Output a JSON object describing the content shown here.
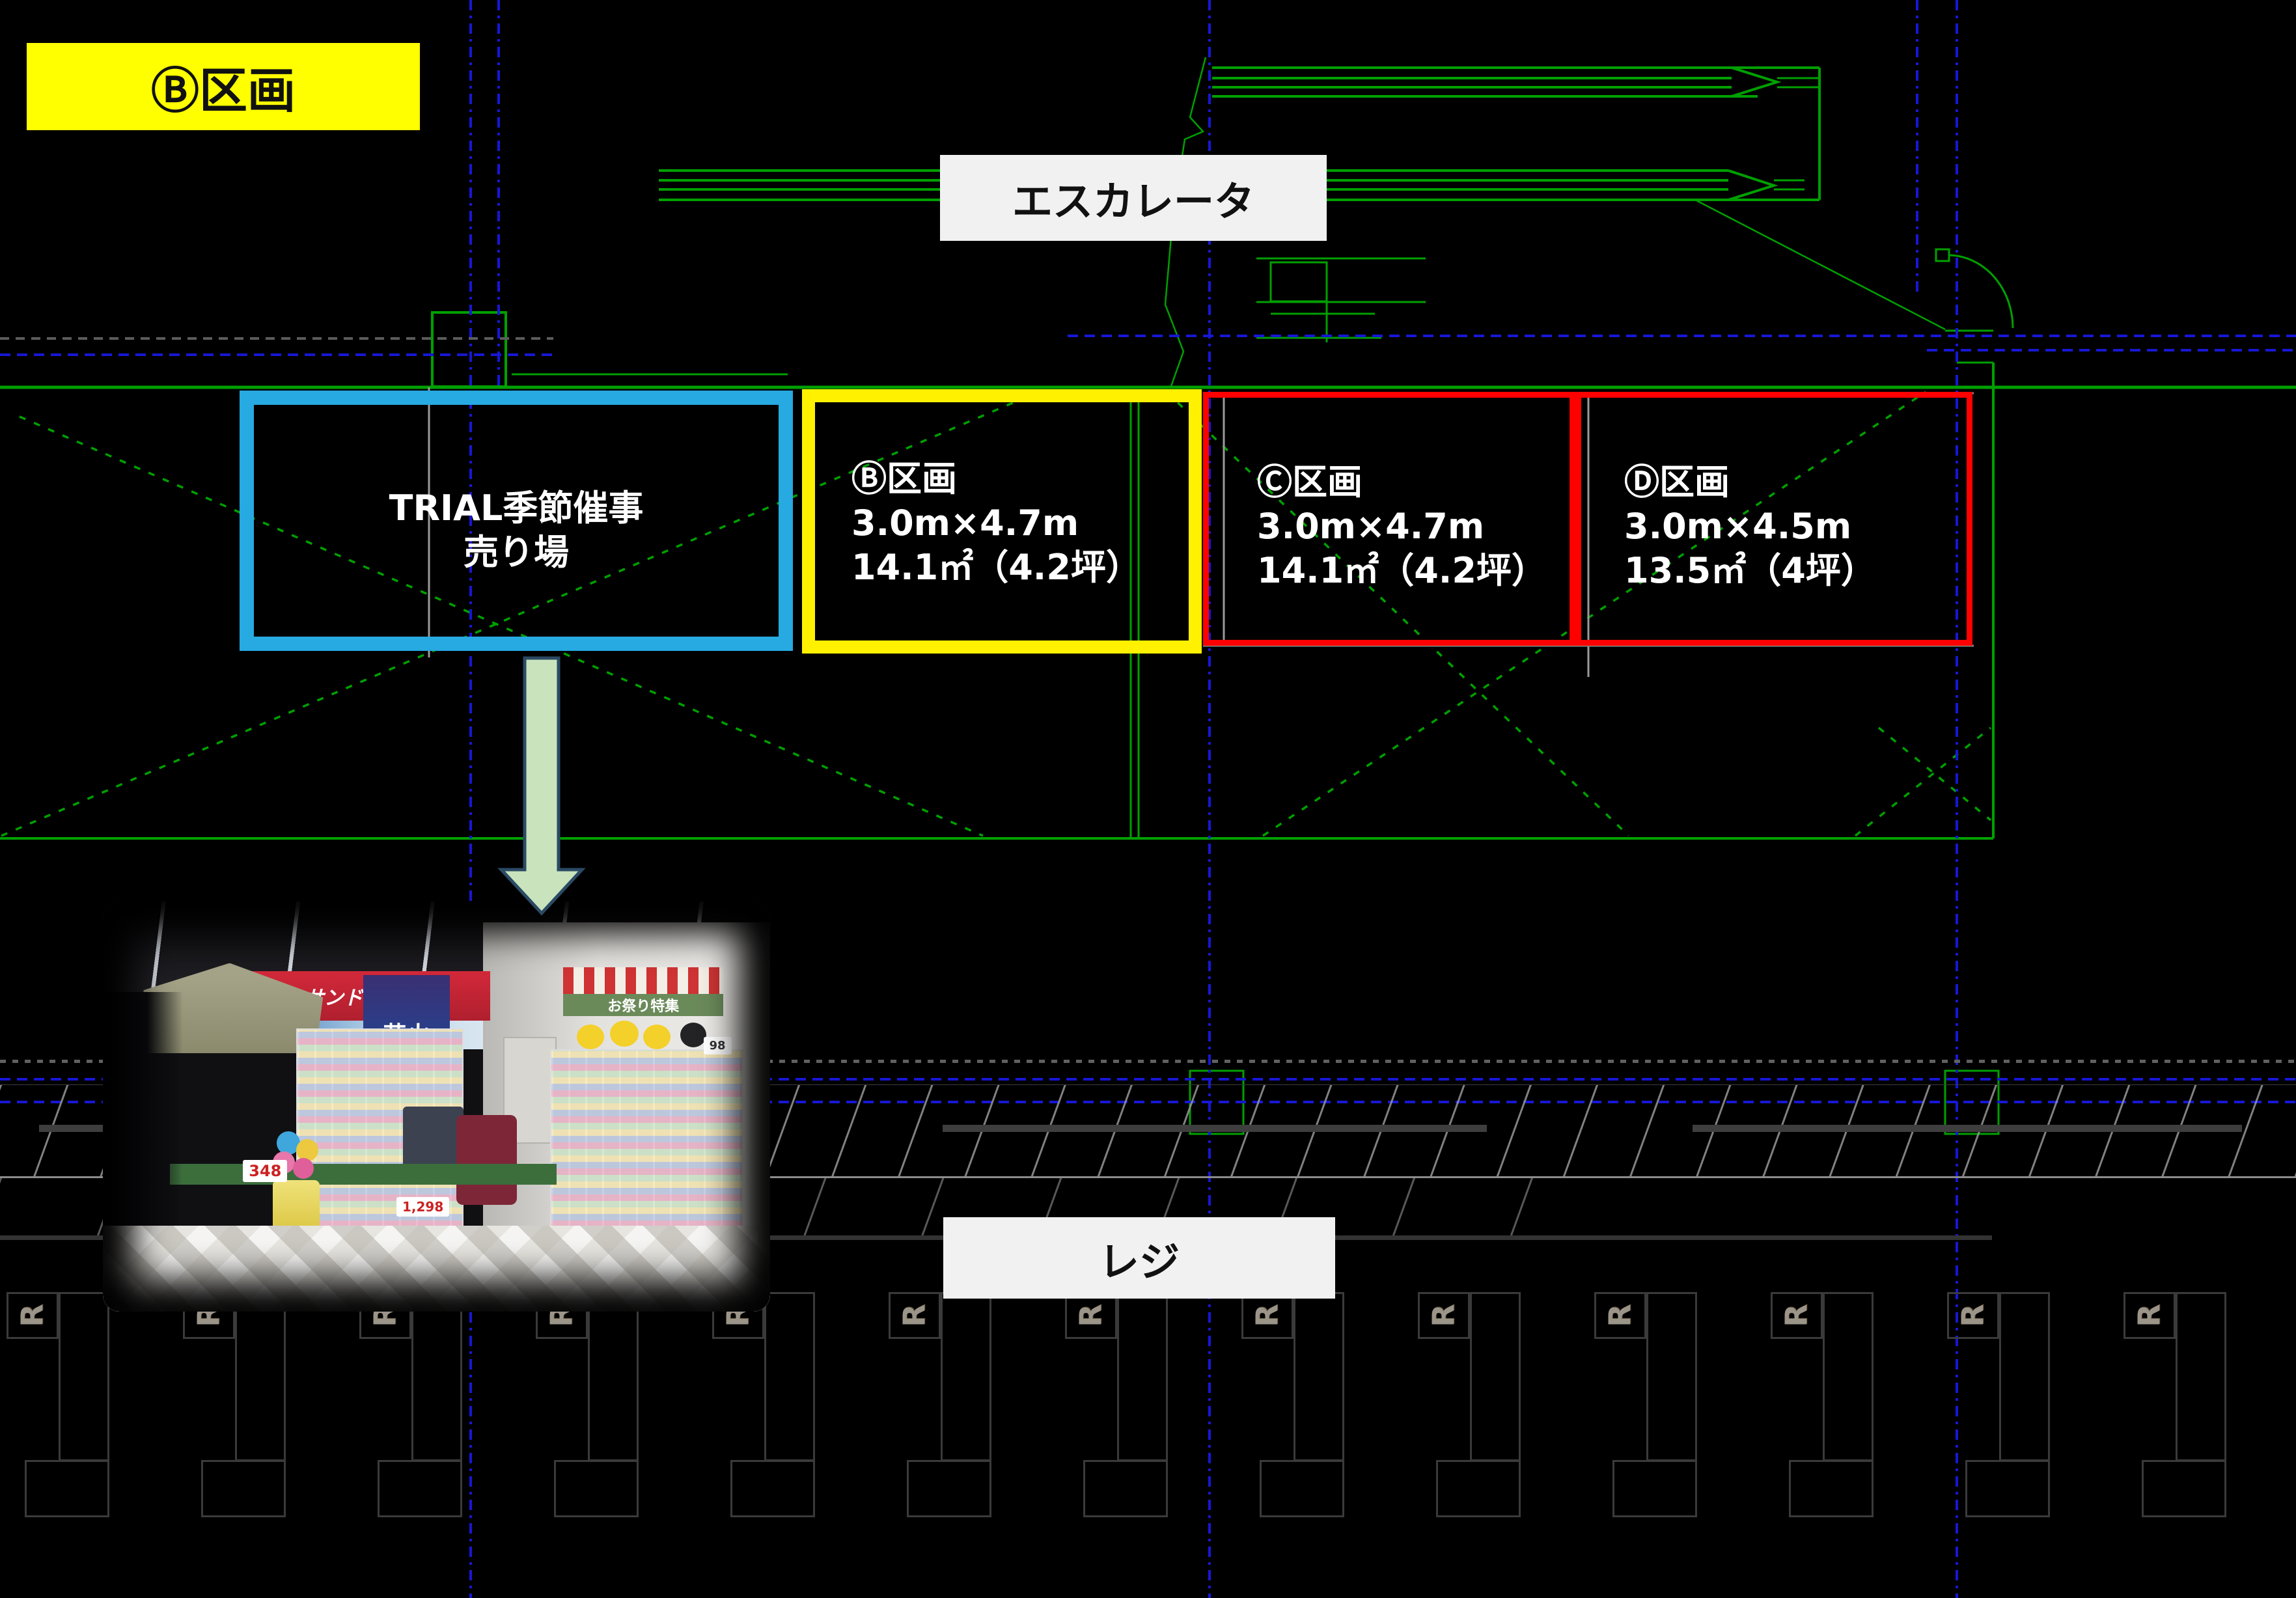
{
  "slide": {
    "title_tag": "Ⓑ区画"
  },
  "labels": {
    "escalator": "エスカレータ",
    "register": "レジ"
  },
  "sections": [
    {
      "id": "trial",
      "highlight": "blue",
      "lines": [
        "TRIAL季節催事",
        "売り場"
      ]
    },
    {
      "id": "b",
      "highlight": "yellow",
      "lines": [
        "Ⓑ区画",
        "3.0m×4.7m",
        "14.1㎡（4.2坪）"
      ]
    },
    {
      "id": "c",
      "highlight": "red",
      "lines": [
        "Ⓒ区画",
        "3.0m×4.7m",
        "14.1㎡（4.2坪）"
      ]
    },
    {
      "id": "d",
      "highlight": "red",
      "lines": [
        "Ⓓ区画",
        "3.0m×4.5m",
        "13.5㎡（4坪）"
      ]
    }
  ],
  "registers": {
    "mark": "R",
    "count": 13
  },
  "photo": {
    "signs": {
      "drugstore": "サンドラッグ",
      "fireworks": "花火",
      "festival": "お祭り特集",
      "price_balloons": "348",
      "price_fireworks": "1,298",
      "price_shelf": "98"
    }
  },
  "colors": {
    "background": "#000000",
    "cad_green": "#00A000",
    "cad_blue": "#1717D6",
    "cad_gray": "#8C8C8C",
    "highlight_blue": "#27A9E1",
    "highlight_yellow": "#FFF100",
    "highlight_red": "#FE0000",
    "tag_yellow": "#FFFF00",
    "label_bg": "#F1F1F1",
    "arrow_fill": "#C9E3BD",
    "arrow_stroke": "#2B4A63",
    "box_text": "#FFFFFF"
  }
}
